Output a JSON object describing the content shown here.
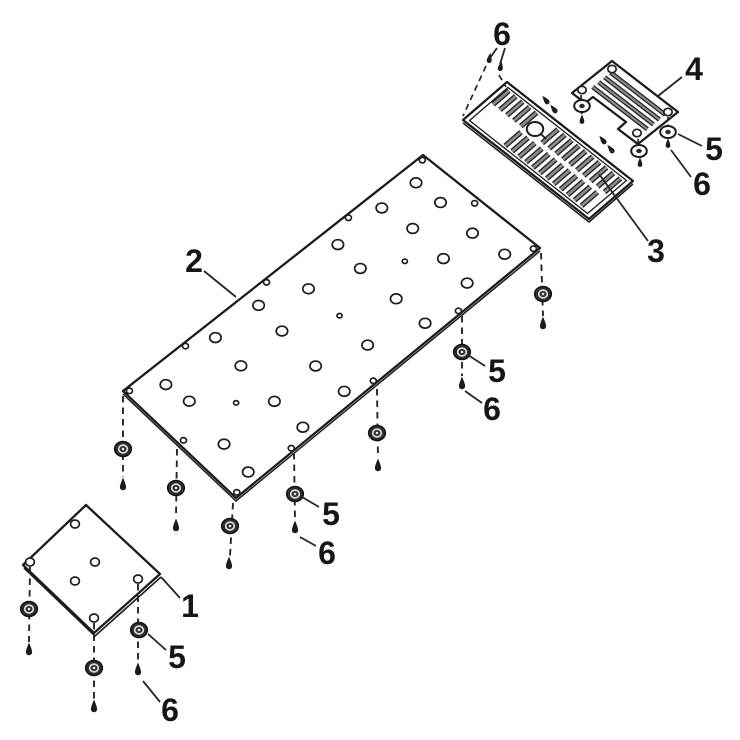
{
  "diagram": {
    "type": "exploded-parts-diagram",
    "background_color": "#ffffff",
    "line_color": "#1c1c1c",
    "slot_fill_color": "#8a8a8a",
    "fastener_color": "#2d2d2d",
    "part_numbers_visible": [
      "1",
      "2",
      "3",
      "4",
      "5",
      "6"
    ],
    "callouts": [
      {
        "id": "callout-6-grate-screws",
        "label": "6",
        "x": 502,
        "y": 45,
        "leaders": [
          {
            "x1": 497,
            "y1": 48,
            "x2": 490,
            "y2": 58
          },
          {
            "x1": 505,
            "y1": 48,
            "x2": 500,
            "y2": 64
          }
        ]
      },
      {
        "id": "callout-4",
        "label": "4",
        "x": 694,
        "y": 80,
        "leaders": [
          {
            "x1": 682,
            "y1": 77,
            "x2": 658,
            "y2": 96
          }
        ]
      },
      {
        "id": "callout-5-right",
        "label": "5",
        "x": 714,
        "y": 160,
        "leaders": [
          {
            "x1": 702,
            "y1": 146,
            "x2": 678,
            "y2": 134
          }
        ]
      },
      {
        "id": "callout-6-right",
        "label": "6",
        "x": 702,
        "y": 195,
        "leaders": [
          {
            "x1": 691,
            "y1": 177,
            "x2": 671,
            "y2": 150
          }
        ]
      },
      {
        "id": "callout-3",
        "label": "3",
        "x": 656,
        "y": 262,
        "leaders": [
          {
            "x1": 648,
            "y1": 241,
            "x2": 599,
            "y2": 174
          }
        ]
      },
      {
        "id": "callout-2",
        "label": "2",
        "x": 194,
        "y": 272,
        "leaders": [
          {
            "x1": 204,
            "y1": 271,
            "x2": 236,
            "y2": 297
          }
        ]
      },
      {
        "id": "callout-5-mid-right",
        "label": "5",
        "x": 497,
        "y": 382,
        "leaders": [
          {
            "x1": 485,
            "y1": 366,
            "x2": 468,
            "y2": 355
          }
        ]
      },
      {
        "id": "callout-6-mid-right",
        "label": "6",
        "x": 492,
        "y": 420,
        "leaders": [
          {
            "x1": 482,
            "y1": 403,
            "x2": 465,
            "y2": 391
          }
        ]
      },
      {
        "id": "callout-5-mid",
        "label": "5",
        "x": 331,
        "y": 525,
        "leaders": [
          {
            "x1": 319,
            "y1": 507,
            "x2": 302,
            "y2": 497
          }
        ]
      },
      {
        "id": "callout-6-mid",
        "label": "6",
        "x": 327,
        "y": 564,
        "leaders": [
          {
            "x1": 316,
            "y1": 546,
            "x2": 300,
            "y2": 537
          }
        ]
      },
      {
        "id": "callout-1",
        "label": "1",
        "x": 190,
        "y": 617,
        "leaders": [
          {
            "x1": 180,
            "y1": 598,
            "x2": 161,
            "y2": 577
          }
        ]
      },
      {
        "id": "callout-5-bottom",
        "label": "5",
        "x": 177,
        "y": 668,
        "leaders": [
          {
            "x1": 166,
            "y1": 650,
            "x2": 148,
            "y2": 634
          }
        ]
      },
      {
        "id": "callout-6-bottom",
        "label": "6",
        "x": 170,
        "y": 721,
        "leaders": [
          {
            "x1": 160,
            "y1": 702,
            "x2": 143,
            "y2": 681
          }
        ]
      }
    ]
  }
}
